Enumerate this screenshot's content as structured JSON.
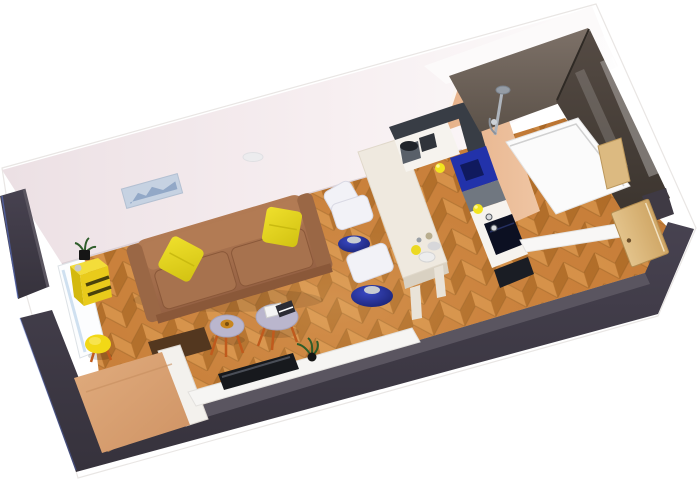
{
  "scene": {
    "description": "3D isometric cutaway render of a studio apartment floor plan, viewed from above at an oblique angle on a white background",
    "view": "top-down oblique 3D render",
    "background": "#ffffff"
  },
  "colors": {
    "bg": "#ffffff",
    "wall-pink": "#ece0e4",
    "wall-white": "#fdfbfb",
    "wall-dark": "#474250",
    "wall-dark-deep": "#36323c",
    "wall-cut-light": "#5a5560",
    "blue-glow": "#5b79e0",
    "floor-light": "#d6924a",
    "floor-mid": "#c9803b",
    "floor-dark": "#b06d29",
    "floor-gap": "#8f5a22",
    "sofa-main": "#a7724e",
    "sofa-light": "#b27b54",
    "sofa-dark": "#8a5839",
    "pillow-yellow": "#e8d71f",
    "picture-blue": "#c6d2e2",
    "picture-deep": "#8ca3c4",
    "shelf-yellow": "#e9cb1b",
    "shelf-yellow-dark": "#d4b90e",
    "pouf-yellow": "#f2d816",
    "table-lavender": "#bab6cd",
    "leg-orange": "#c05a1d",
    "bowl-gold": "#c8861f",
    "console-white": "#f6f5f3",
    "tv-dark": "#17191d",
    "plant-green": "#2e5d2a",
    "plant-pot": "#161616",
    "bed-tan": "#d9a174",
    "bed-frame": "#f3f1ed",
    "peach-wall": "#e2a87d",
    "peach-wall-light": "#efc5a3",
    "cabinet-white": "#f6f3ee",
    "counter-dark": "#383d45",
    "sink-blue": "#2232aa",
    "sink-blue-deep": "#101a5e",
    "metal-gray": "#707780",
    "cooktop-dark": "#0c1022",
    "machine-gray": "#596069",
    "yellow-accent": "#f2e41f",
    "bar-table": "#efe9df",
    "bar-table-edge": "#d9d1c2",
    "chair-white": "#f2f2f7",
    "chair-blue": "#2d3bb3",
    "chair-blue-deep": "#18206e",
    "tile-brown": "#6a5f57",
    "tile-brown-deep": "#473f39",
    "tray-white": "#fbfbfb",
    "chrome": "#aeb4bc",
    "door-tan": "#dcba81",
    "door-tan-deep": "#c49a5f"
  },
  "rooms": [
    {
      "name": "living-area",
      "floor": "herringbone-parquet",
      "objects": [
        "brown-sofa",
        "yellow-cushion-left",
        "yellow-cushion-right",
        "wall-picture",
        "ceiling-light",
        "round-coffee-table-small",
        "decor-bowl",
        "round-coffee-table-large",
        "books",
        "yellow-shelf-unit",
        "potted-plant",
        "yellow-pouf",
        "tv-sideboard",
        "tv",
        "sideboard-plant",
        "bed-with-tan-cover",
        "window"
      ]
    },
    {
      "name": "kitchen",
      "objects": [
        "peach-accent-wall",
        "l-shaped-counter",
        "sink",
        "cooktop",
        "coffee-machine",
        "pendant-light-1",
        "pendant-light-2",
        "bar-table",
        "tableware",
        "white-chair-blue-base-1",
        "white-chair-blue-base-2"
      ]
    },
    {
      "name": "bathroom",
      "objects": [
        "dark-tile-walls",
        "walk-in-shower",
        "glass-screen",
        "shower-tray",
        "shower-fixture"
      ]
    },
    {
      "name": "entry",
      "objects": [
        "wooden-door-open",
        "door-frame"
      ]
    }
  ]
}
